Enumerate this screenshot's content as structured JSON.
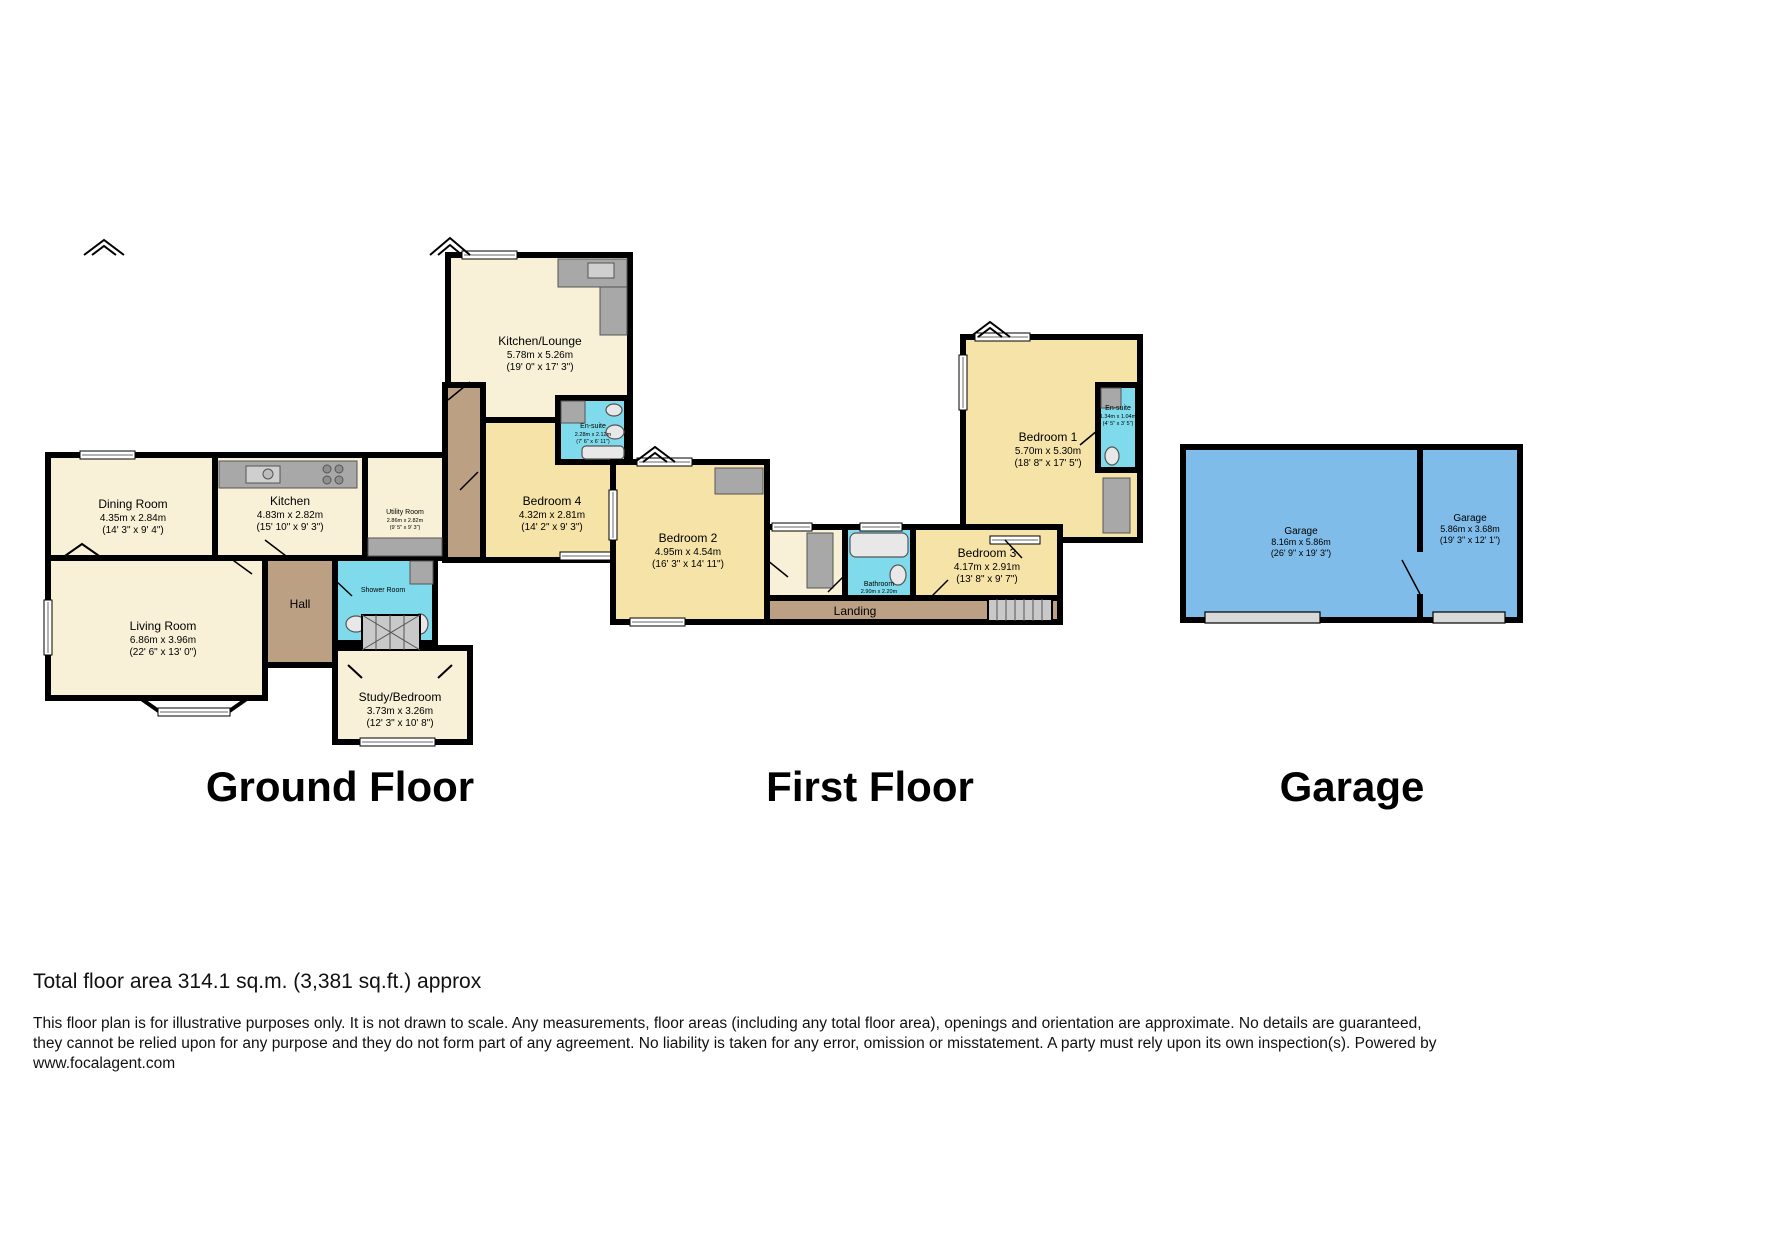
{
  "titles": {
    "ground": "Ground Floor",
    "first": "First Floor",
    "garage": "Garage"
  },
  "ground": {
    "rooms": {
      "kitchen_lounge": {
        "name": "Kitchen/Lounge",
        "metric": "5.78m x 5.26m",
        "imperial": "(19' 0\" x 17' 3\")"
      },
      "dining": {
        "name": "Dining Room",
        "metric": "4.35m x 2.84m",
        "imperial": "(14' 3\" x 9' 4\")"
      },
      "kitchen": {
        "name": "Kitchen",
        "metric": "4.83m x 2.82m",
        "imperial": "(15' 10\" x 9' 3\")"
      },
      "utility": {
        "name": "Utility Room",
        "metric": "2.86m x 2.82m",
        "imperial": "(9' 5\" x 9' 3\")"
      },
      "bedroom4": {
        "name": "Bedroom 4",
        "metric": "4.32m x 2.81m",
        "imperial": "(14' 2\" x 9' 3\")"
      },
      "living": {
        "name": "Living Room",
        "metric": "6.86m x 3.96m",
        "imperial": "(22' 6\" x 13' 0\")"
      },
      "hall": {
        "name": "Hall"
      },
      "shower": {
        "name": "Shower Room"
      },
      "ensuite": {
        "name": "En-suite",
        "metric": "2.28m x 2.12m",
        "imperial": "(7' 6\" x 6' 11\")"
      },
      "study": {
        "name": "Study/Bedroom",
        "metric": "3.73m x 3.26m",
        "imperial": "(12' 3\" x 10' 8\")"
      }
    }
  },
  "first": {
    "rooms": {
      "bedroom1": {
        "name": "Bedroom 1",
        "metric": "5.70m x 5.30m",
        "imperial": "(18' 8\" x 17' 5\")"
      },
      "bedroom2": {
        "name": "Bedroom 2",
        "metric": "4.95m x 4.54m",
        "imperial": "(16' 3\" x 14' 11\")"
      },
      "bedroom3": {
        "name": "Bedroom 3",
        "metric": "4.17m x 2.91m",
        "imperial": "(13' 8\" x 9' 7\")"
      },
      "bathroom": {
        "name": "Bathroom",
        "metric": "2.90m x 2.20m",
        "imperial": "(9' 6\" x 7' 3\")"
      },
      "landing": {
        "name": "Landing"
      },
      "ensuite": {
        "name": "En-suite",
        "metric": "1.34m x 1.04m",
        "imperial": "(4' 5\" x 3' 5\")"
      }
    }
  },
  "garage_plan": {
    "rooms": {
      "garage_left": {
        "name": "Garage",
        "metric": "8.16m x 5.86m",
        "imperial": "(26' 9\" x 19' 3\")"
      },
      "garage_right": {
        "name": "Garage",
        "metric": "5.86m x 3.68m",
        "imperial": "(19' 3\" x 12' 1\")"
      }
    }
  },
  "footer": {
    "total_area": "Total floor area 314.1 sq.m. (3,381 sq.ft.) approx",
    "disclaimer_line1": "This floor plan is for illustrative purposes only. It is not drawn to scale. Any measurements, floor areas (including any total floor area), openings and orientation are approximate. No details are guaranteed,",
    "disclaimer_line2": "they cannot be relied upon for any purpose and they do not form part of any agreement. No liability is taken for any error, omission or misstatement. A party must rely upon its own inspection(s). Powered by",
    "disclaimer_line3": "www.focalagent.com"
  },
  "colors": {
    "room_cream": "#f8f1d8",
    "room_yellow": "#f6e3a8",
    "hall_brown": "#bba084",
    "wet_room_cyan": "#7fdbec",
    "garage_blue": "#80bce9",
    "fixture_gray": "#a8a8a8",
    "wall_black": "#000000"
  }
}
